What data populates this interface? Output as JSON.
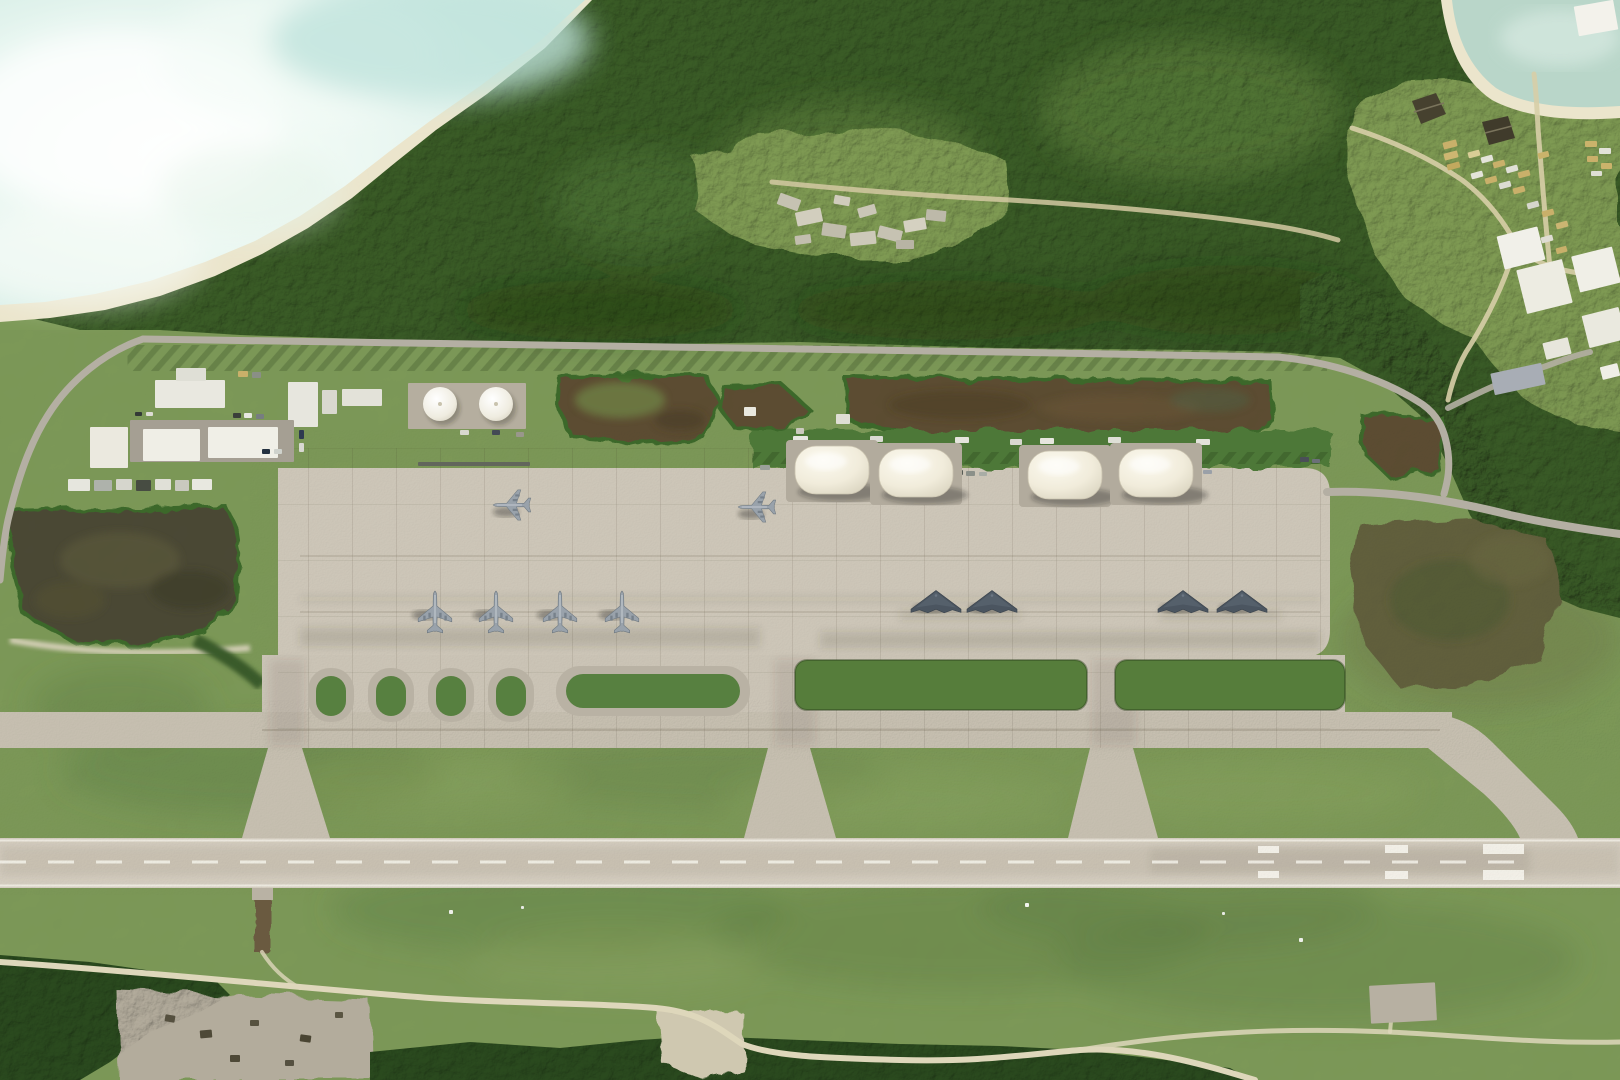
{
  "meta": {
    "type": "satellite-image",
    "subject": "Overhead satellite photograph of an island military airbase: concrete parking apron with stealth bombers and tanker aircraft, four white dome aircraft shelters, fuel farm and support buildings, parallel taxiway and single runway, dense tropical forest, beach and lagoon shoreline",
    "visible_text": "none"
  },
  "colors": {
    "grass": "#7d9a58",
    "forest": "#3a5c26",
    "forest_dark": "#2a4a1e",
    "apron": "#cdc6b8",
    "taxiway": "#c6bfb0",
    "runway": "#d4cdc0",
    "water": "#ddf0e9",
    "cove_water": "#b9d6c9",
    "sand": "#ebe5cc",
    "scrub": "#5d4d33",
    "wetland": "#4c4a34",
    "dome": "#f1ecdb",
    "road": "#b4afa3",
    "dirt_path": "#d8cfaa",
    "island_green": "#578040",
    "clearing_green": "#7f9b52"
  },
  "features": {
    "lagoon": {
      "label": "lagoon-and-beach",
      "position": "top-left"
    },
    "cove": {
      "label": "cove-beach",
      "position": "top-right-corner"
    },
    "forest": {
      "label": "dense-tropical-forest",
      "position": "upper-band-and-right-side"
    },
    "rubble_clearing": {
      "label": "forest-clearing-with-rubble-piles",
      "position": "top-center"
    },
    "vehicle_camp": {
      "label": "vehicle-and-container-staging-area",
      "position": "top-right",
      "pyramid_structures": 2
    },
    "support_area": {
      "label": "support-buildings-and-fuel-farm",
      "buildings": 9,
      "fuel_tanks": 2,
      "tank_positions": [
        [
          440,
          404,
          17
        ],
        [
          496,
          404,
          17
        ]
      ],
      "truck_row": 7
    },
    "scrub_patches": {
      "count": 5,
      "label": "dark-scrub-patches-with-hedge-borders"
    },
    "wetland_patch": {
      "count": 1,
      "label": "dark-wetland-scrub",
      "position": "left-of-apron"
    },
    "shelters": {
      "count": 4,
      "label": "white-dome-portable-aircraft-shelters",
      "size": {
        "w": 74,
        "h": 48
      },
      "positions": [
        [
          795,
          446
        ],
        [
          879,
          449
        ],
        [
          1028,
          451
        ],
        [
          1119,
          449
        ]
      ],
      "container_stacks": 2
    },
    "aircraft": {
      "total": 10,
      "groups": [
        {
          "type": "tanker",
          "label": "large-swept-wing-aircraft-parked-facing-west",
          "heading_deg": 270,
          "scale": 0.9,
          "shadow": [
            -6,
            7
          ],
          "positions": [
            [
              512,
              505
            ],
            [
              757,
              507
            ]
          ]
        },
        {
          "type": "tanker",
          "label": "large-swept-wing-aircraft-row-facing-north",
          "heading_deg": 0,
          "scale": 1,
          "shadow": [
            -10,
            3
          ],
          "positions": [
            [
              435,
              612
            ],
            [
              496,
              612
            ],
            [
              560,
              612
            ],
            [
              622,
              612
            ]
          ]
        },
        {
          "type": "b2",
          "label": "flying-wing-stealth-bomber",
          "heading_deg": 0,
          "scale": 1,
          "shadow": [
            -6,
            7
          ],
          "positions": [
            [
              936,
              601
            ],
            [
              992,
              601
            ],
            [
              1183,
              601
            ],
            [
              1242,
              601
            ]
          ]
        }
      ]
    },
    "apron": {
      "label": "large-concrete-parking-apron"
    },
    "parallel_taxiway": {
      "label": "parallel-taxiway",
      "connectors_to_runway": 4
    },
    "runway": {
      "label": "single-runway",
      "centerline": "white-dashed",
      "edge_lines": "white-solid",
      "aiming_point_marks": 3
    },
    "grass_islands": {
      "small_ovals": 4,
      "long_strips": 3
    }
  },
  "sprites": {
    "rects": [
      [
        408,
        383,
        118,
        46,
        "#b5ae9f",
        0
      ],
      [
        288,
        382,
        30,
        45,
        "#e7e6de",
        0
      ],
      [
        322,
        390,
        15,
        24,
        "#d9d8cf",
        0
      ],
      [
        342,
        389,
        40,
        17,
        "#e3e2d9",
        0
      ],
      [
        155,
        380,
        70,
        28,
        "#e9e8e0",
        0
      ],
      [
        176,
        368,
        30,
        13,
        "#dfdfd6",
        0
      ],
      [
        130,
        420,
        164,
        42,
        "#a59f93",
        0
      ],
      [
        90,
        427,
        38,
        41,
        "#ebe9df",
        0
      ],
      [
        143,
        429,
        57,
        32,
        "#efeee6",
        0
      ],
      [
        208,
        427,
        70,
        31,
        "#f0efe7",
        0
      ],
      [
        233,
        413,
        8,
        5,
        "#3a3f3a",
        0
      ],
      [
        244,
        413,
        8,
        5,
        "#e8e8e2",
        0
      ],
      [
        256,
        414,
        8,
        5,
        "#777d80",
        0
      ],
      [
        299,
        430,
        5,
        9,
        "#2e3a50",
        0
      ],
      [
        299,
        443,
        5,
        9,
        "#d8d8d2",
        0
      ],
      [
        135,
        412,
        7,
        4,
        "#333a36",
        0
      ],
      [
        146,
        412,
        7,
        4,
        "#dddcd4",
        0
      ],
      [
        262,
        449,
        8,
        5,
        "#23303f",
        0
      ],
      [
        274,
        449,
        8,
        5,
        "#cfd2cc",
        0
      ],
      [
        460,
        430,
        9,
        5,
        "#d8d8d0",
        0
      ],
      [
        492,
        430,
        8,
        5,
        "#434a55",
        0
      ],
      [
        516,
        432,
        8,
        5,
        "#99978b",
        0
      ],
      [
        68,
        479,
        22,
        12,
        "#e6e6de",
        0
      ],
      [
        94,
        480,
        18,
        11,
        "#aeb2ab",
        0
      ],
      [
        116,
        479,
        16,
        11,
        "#d6d6cd",
        0
      ],
      [
        136,
        480,
        15,
        11,
        "#474c42",
        0
      ],
      [
        155,
        479,
        16,
        11,
        "#e0e0d7",
        0
      ],
      [
        175,
        480,
        14,
        11,
        "#c9c9bf",
        0
      ],
      [
        192,
        479,
        20,
        11,
        "#e8e8e0",
        0
      ],
      [
        238,
        371,
        10,
        6,
        "#c9b06a",
        0
      ],
      [
        252,
        372,
        9,
        6,
        "#8a8f86",
        0
      ],
      [
        418,
        462,
        112,
        4,
        "#62665c",
        0
      ],
      [
        744,
        407,
        12,
        9,
        "#e9e8df",
        0
      ],
      [
        836,
        414,
        14,
        10,
        "#dfded4",
        0
      ],
      [
        796,
        428,
        8,
        6,
        "#cccabf",
        0
      ],
      [
        864,
        450,
        16,
        46,
        "#c2ab60",
        0
      ],
      [
        1097,
        450,
        16,
        46,
        "#c2ab60",
        0
      ],
      [
        793,
        436,
        15,
        7,
        "#e8e8e2",
        0
      ],
      [
        870,
        436,
        13,
        6,
        "#dadad2",
        0
      ],
      [
        955,
        437,
        14,
        6,
        "#e4e4dc",
        0
      ],
      [
        1010,
        439,
        12,
        6,
        "#d8d8d0",
        0
      ],
      [
        1040,
        438,
        14,
        6,
        "#e6e6de",
        0
      ],
      [
        1108,
        437,
        13,
        6,
        "#dedfd6",
        0
      ],
      [
        1196,
        439,
        14,
        6,
        "#e2e2da",
        0
      ],
      [
        952,
        470,
        11,
        5,
        "#565b54",
        0
      ],
      [
        966,
        471,
        9,
        5,
        "#8b9089",
        0
      ],
      [
        979,
        472,
        8,
        4,
        "#a9ada6",
        0
      ],
      [
        1158,
        460,
        15,
        6,
        "#d5d7cf",
        -8
      ],
      [
        1177,
        467,
        10,
        5,
        "#7e838b",
        0
      ],
      [
        1190,
        469,
        9,
        5,
        "#5d636b",
        0
      ],
      [
        1203,
        470,
        9,
        4,
        "#9aa0a8",
        0
      ],
      [
        1300,
        457,
        9,
        5,
        "#4a4f57",
        0
      ],
      [
        1312,
        459,
        8,
        4,
        "#6b7078",
        0
      ],
      [
        760,
        465,
        10,
        5,
        "#9aa09a",
        0
      ],
      [
        1443,
        141,
        14,
        7,
        "#c9b06a",
        -15
      ],
      [
        1444,
        152,
        14,
        7,
        "#cdb671",
        -15
      ],
      [
        1447,
        163,
        13,
        6,
        "#c2a95e",
        -15
      ],
      [
        1468,
        151,
        12,
        6,
        "#d9cd96",
        -15
      ],
      [
        1481,
        156,
        12,
        6,
        "#e4e4da",
        -15
      ],
      [
        1493,
        161,
        12,
        6,
        "#c9b06a",
        -15
      ],
      [
        1506,
        166,
        12,
        6,
        "#e0e0d6",
        -15
      ],
      [
        1518,
        171,
        12,
        6,
        "#c9b06a",
        -15
      ],
      [
        1471,
        172,
        12,
        6,
        "#e4e4da",
        -15
      ],
      [
        1485,
        177,
        12,
        6,
        "#c9b06a",
        -15
      ],
      [
        1499,
        182,
        12,
        6,
        "#dcdcd2",
        -15
      ],
      [
        1513,
        187,
        12,
        6,
        "#c9b06a",
        -15
      ],
      [
        1538,
        152,
        11,
        6,
        "#cbb36b",
        -15
      ],
      [
        1527,
        202,
        12,
        6,
        "#d6d6cc",
        -15
      ],
      [
        1542,
        210,
        12,
        6,
        "#c9b06a",
        -15
      ],
      [
        1556,
        222,
        12,
        6,
        "#cbb572",
        -15
      ],
      [
        1541,
        236,
        12,
        6,
        "#dedcd2",
        -15
      ],
      [
        1556,
        247,
        11,
        6,
        "#c9b06a",
        -15
      ],
      [
        1585,
        141,
        12,
        6,
        "#cbb36b",
        0
      ],
      [
        1599,
        148,
        12,
        6,
        "#e2e2d8",
        0
      ],
      [
        1587,
        156,
        11,
        6,
        "#c9b06a",
        0
      ],
      [
        1601,
        163,
        11,
        6,
        "#cbb36b",
        0
      ],
      [
        1591,
        171,
        11,
        5,
        "#dfdfd5",
        0
      ],
      [
        1500,
        231,
        42,
        34,
        "#f1f0e9",
        -14
      ],
      [
        1521,
        264,
        47,
        45,
        "#edece2",
        -14
      ],
      [
        1575,
        251,
        42,
        37,
        "#f0efe7",
        -14
      ],
      [
        1585,
        311,
        38,
        33,
        "#eae9df",
        -14
      ],
      [
        1544,
        340,
        26,
        17,
        "#e7e6dc",
        -14
      ],
      [
        1601,
        365,
        18,
        13,
        "#efeee6",
        -14
      ],
      [
        1492,
        368,
        52,
        22,
        "#a8adb5",
        -12
      ],
      [
        1576,
        3,
        40,
        30,
        "#f3f2eb",
        -10
      ],
      [
        778,
        196,
        22,
        12,
        "#c6c2b2",
        20
      ],
      [
        796,
        210,
        26,
        14,
        "#d2cebe",
        -12
      ],
      [
        822,
        224,
        24,
        13,
        "#c0bcac",
        8
      ],
      [
        850,
        232,
        26,
        13,
        "#cdc9b9",
        -6
      ],
      [
        878,
        228,
        24,
        12,
        "#c6c2b2",
        14
      ],
      [
        904,
        219,
        22,
        12,
        "#d5d1c1",
        -10
      ],
      [
        926,
        210,
        20,
        11,
        "#bdb9a9",
        6
      ],
      [
        858,
        206,
        18,
        10,
        "#cac6b6",
        -16
      ],
      [
        834,
        196,
        16,
        9,
        "#d0ccbc",
        10
      ],
      [
        896,
        240,
        18,
        9,
        "#b8b4a4",
        0
      ],
      [
        795,
        235,
        16,
        9,
        "#c2beae",
        -8
      ],
      [
        1370,
        984,
        66,
        38,
        "#b7b0a2",
        -3
      ],
      [
        165,
        1015,
        10,
        7,
        "#55503f",
        10
      ],
      [
        200,
        1030,
        12,
        8,
        "#4e4937",
        -5
      ],
      [
        250,
        1020,
        9,
        6,
        "#57523f",
        0
      ],
      [
        300,
        1035,
        11,
        7,
        "#4a4533",
        8
      ],
      [
        335,
        1012,
        8,
        6,
        "#5a5542",
        0
      ],
      [
        230,
        1055,
        10,
        7,
        "#4e4937",
        0
      ],
      [
        285,
        1060,
        9,
        6,
        "#555040",
        0
      ],
      [
        449,
        910,
        4,
        4,
        "#eef0ea",
        0
      ],
      [
        1025,
        903,
        4,
        4,
        "#f2f4ee",
        0
      ],
      [
        1299,
        938,
        4,
        4,
        "#eef0ea",
        0
      ],
      [
        521,
        906,
        3,
        3,
        "#e8eae4",
        0
      ],
      [
        1222,
        912,
        3,
        3,
        "#e8eae4",
        0
      ]
    ]
  }
}
